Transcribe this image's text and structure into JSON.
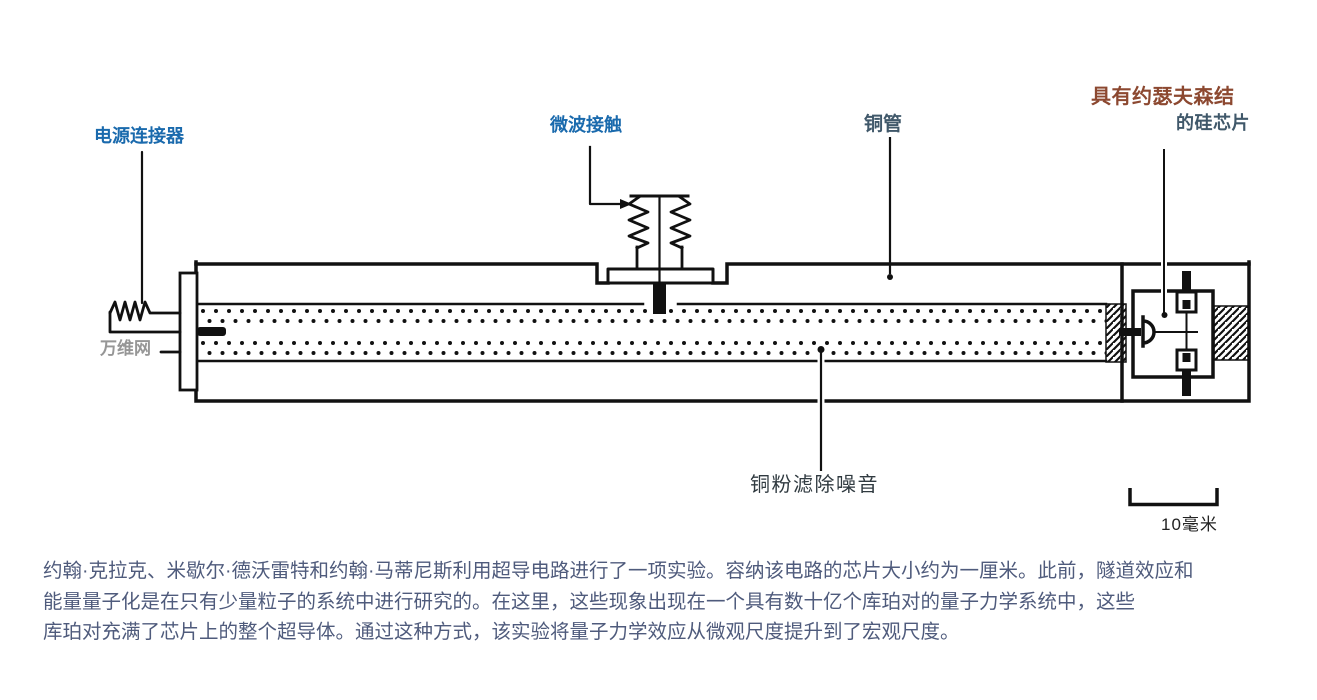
{
  "diagram": {
    "labels": {
      "power_connector": "电源连接器",
      "microwave_contact": "微波接触",
      "copper_tube": "铜管",
      "josephson_chip_line1": "具有约瑟夫森结",
      "josephson_chip_line2": "的硅芯片",
      "copper_powder": "铜粉滤除噪音",
      "scale_bar": "10毫米",
      "watermark": "万维网"
    },
    "colors": {
      "label_blue": "#1a6aad",
      "label_slate": "#40586a",
      "label_brown": "#8c4830",
      "caption_text": "#4f5b7c",
      "line_ink": "#111111"
    }
  },
  "caption": {
    "lines": [
      "约翰·克拉克、米歇尔·德沃雷特和约翰·马蒂尼斯利用超导电路进行了一项实验。容纳该电路的芯片大小约为一厘米。此前，隧道效应和",
      "能量量子化是在只有少量粒子的系统中进行研究的。在这里，这些现象出现在一个具有数十亿个库珀对的量子力学系统中，这些",
      "库珀对充满了芯片上的整个超导体。通过这种方式，该实验将量子力学效应从微观尺度提升到了宏观尺度。"
    ]
  }
}
